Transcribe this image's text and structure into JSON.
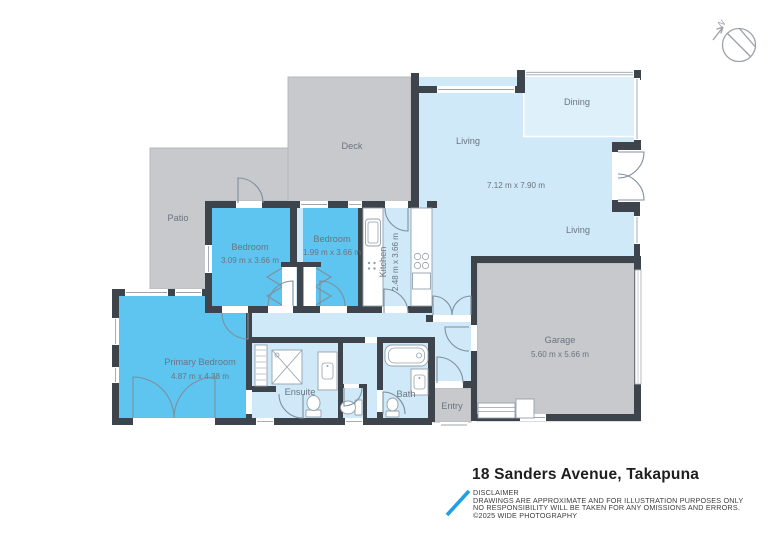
{
  "compass": {
    "label": "N"
  },
  "rooms": {
    "deck": "Deck",
    "patio": "Patio",
    "living_label_upper": "Living",
    "dining": "Dining",
    "living_dims": "7.12 m x 7.90 m",
    "living_label_lower": "Living",
    "bedroom_1": {
      "label": "Bedroom",
      "dims": "3.09 m x 3.66 m"
    },
    "bedroom_2": {
      "label": "Bedroom",
      "dims": "1.99 m x 3.66 m"
    },
    "kitchen": {
      "label": "Kitchen",
      "dims": "2.48 m x 3.66 m"
    },
    "primary_bedroom": {
      "label": "Primary Bedroom",
      "dims": "4.87 m x 4.38 m"
    },
    "ensuite": "Ensuite",
    "bath": "Bath",
    "entry": "Entry",
    "garage": {
      "label": "Garage",
      "dims": "5.60 m x 5.66 m"
    }
  },
  "footer": {
    "title": "18 Sanders Avenue, Takapuna",
    "disclaimer_heading": "DISCLAIMER",
    "disclaimer_lines": [
      "DRAWINGS ARE APPROXIMATE AND FOR ILLUSTRATION PURPOSES ONLY",
      "NO RESPONSIBILITY WILL BE TAKEN FOR ANY OMISSIONS AND ERRORS.",
      "©2025 WIDE PHOTOGRAPHY"
    ]
  },
  "colors": {
    "wall": "#3e444b",
    "outdoor_gray": "#c7c9cc",
    "indoor_light_blue": "#cfe9f8",
    "dining_band_blue": "#def1fb",
    "bedroom_blue": "#5dc5ef",
    "label_gray": "#6b7480",
    "logo_blue": "#209fe6"
  }
}
